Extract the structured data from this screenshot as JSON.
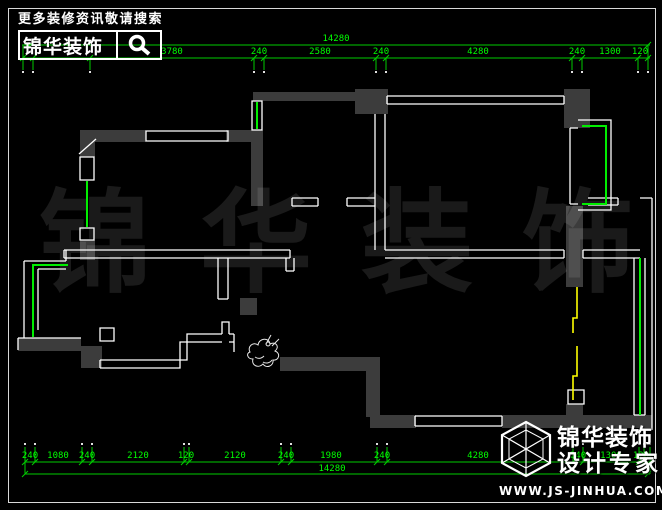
{
  "header": {
    "search_hint": "更多装修资讯敬请搜索",
    "brand": "锦华装饰"
  },
  "watermark": {
    "chars": [
      "锦",
      "华",
      "装",
      "饰"
    ]
  },
  "dimensions": {
    "top": {
      "overall": "14280",
      "segments": [
        "3780",
        "240",
        "2580",
        "240",
        "4280",
        "240",
        "1300",
        "120"
      ]
    },
    "bottom": {
      "overall": "14280",
      "segments": [
        "240",
        "1080",
        "240",
        "2120",
        "120",
        "2120",
        "240",
        "1980",
        "240",
        "4280",
        "240",
        "1300",
        "120"
      ]
    }
  },
  "footer": {
    "brand": "锦华装饰",
    "tagline": "设计专家",
    "website": "WWW.JS-JINHUA.COM"
  },
  "colors": {
    "background": "#000000",
    "frame": "#d9d9d9",
    "wall_fill": "#3c3c3c",
    "wall_line": "#ffffff",
    "window": "#00ee00",
    "dim_line": "#00cc00",
    "dim_text": "#00ff00",
    "sliding_door": "#ffff00",
    "watermark": "rgba(255,255,255,0.10)"
  }
}
